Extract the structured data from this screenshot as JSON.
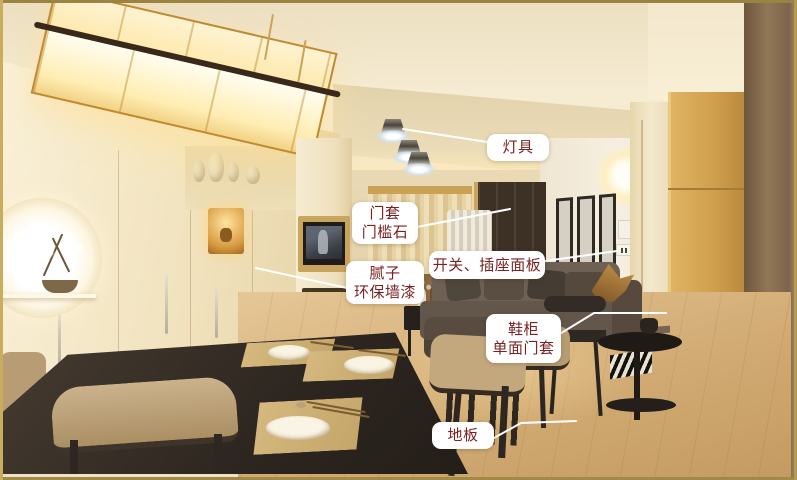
{
  "annotations": {
    "items": [
      {
        "key": "lighting-fixture",
        "lines": [
          "灯具"
        ]
      },
      {
        "key": "door-casing-threshold-stone",
        "lines": [
          "门套",
          "门槛石"
        ]
      },
      {
        "key": "switch-socket-panel",
        "lines": [
          "开关、插座面板"
        ]
      },
      {
        "key": "putty-eco-wall-paint",
        "lines": [
          "腻子",
          "环保墙漆"
        ]
      },
      {
        "key": "shoe-cabinet-single-side-casing",
        "lines": [
          "鞋柜",
          "单面门套"
        ]
      },
      {
        "key": "floor",
        "lines": [
          "地板"
        ]
      }
    ],
    "style": {
      "label_text_color": "#7a2121",
      "label_background": "#ffffff",
      "leader_line_color": "#ffffff"
    }
  },
  "colors": {
    "frame_border": "#a98f4a",
    "ceiling_cream": "#f3e6c4",
    "wall_cream": "#f4ead2",
    "shoe_cabinet_wood": "#cf9f4c",
    "dark_wood_panel": "#86694a",
    "floor_wood": "#d2ab74",
    "sofa": "#63564a",
    "dining_table": "#2d2620",
    "placemat": "#cdb076",
    "lamp_glow": "#ffedb2"
  }
}
